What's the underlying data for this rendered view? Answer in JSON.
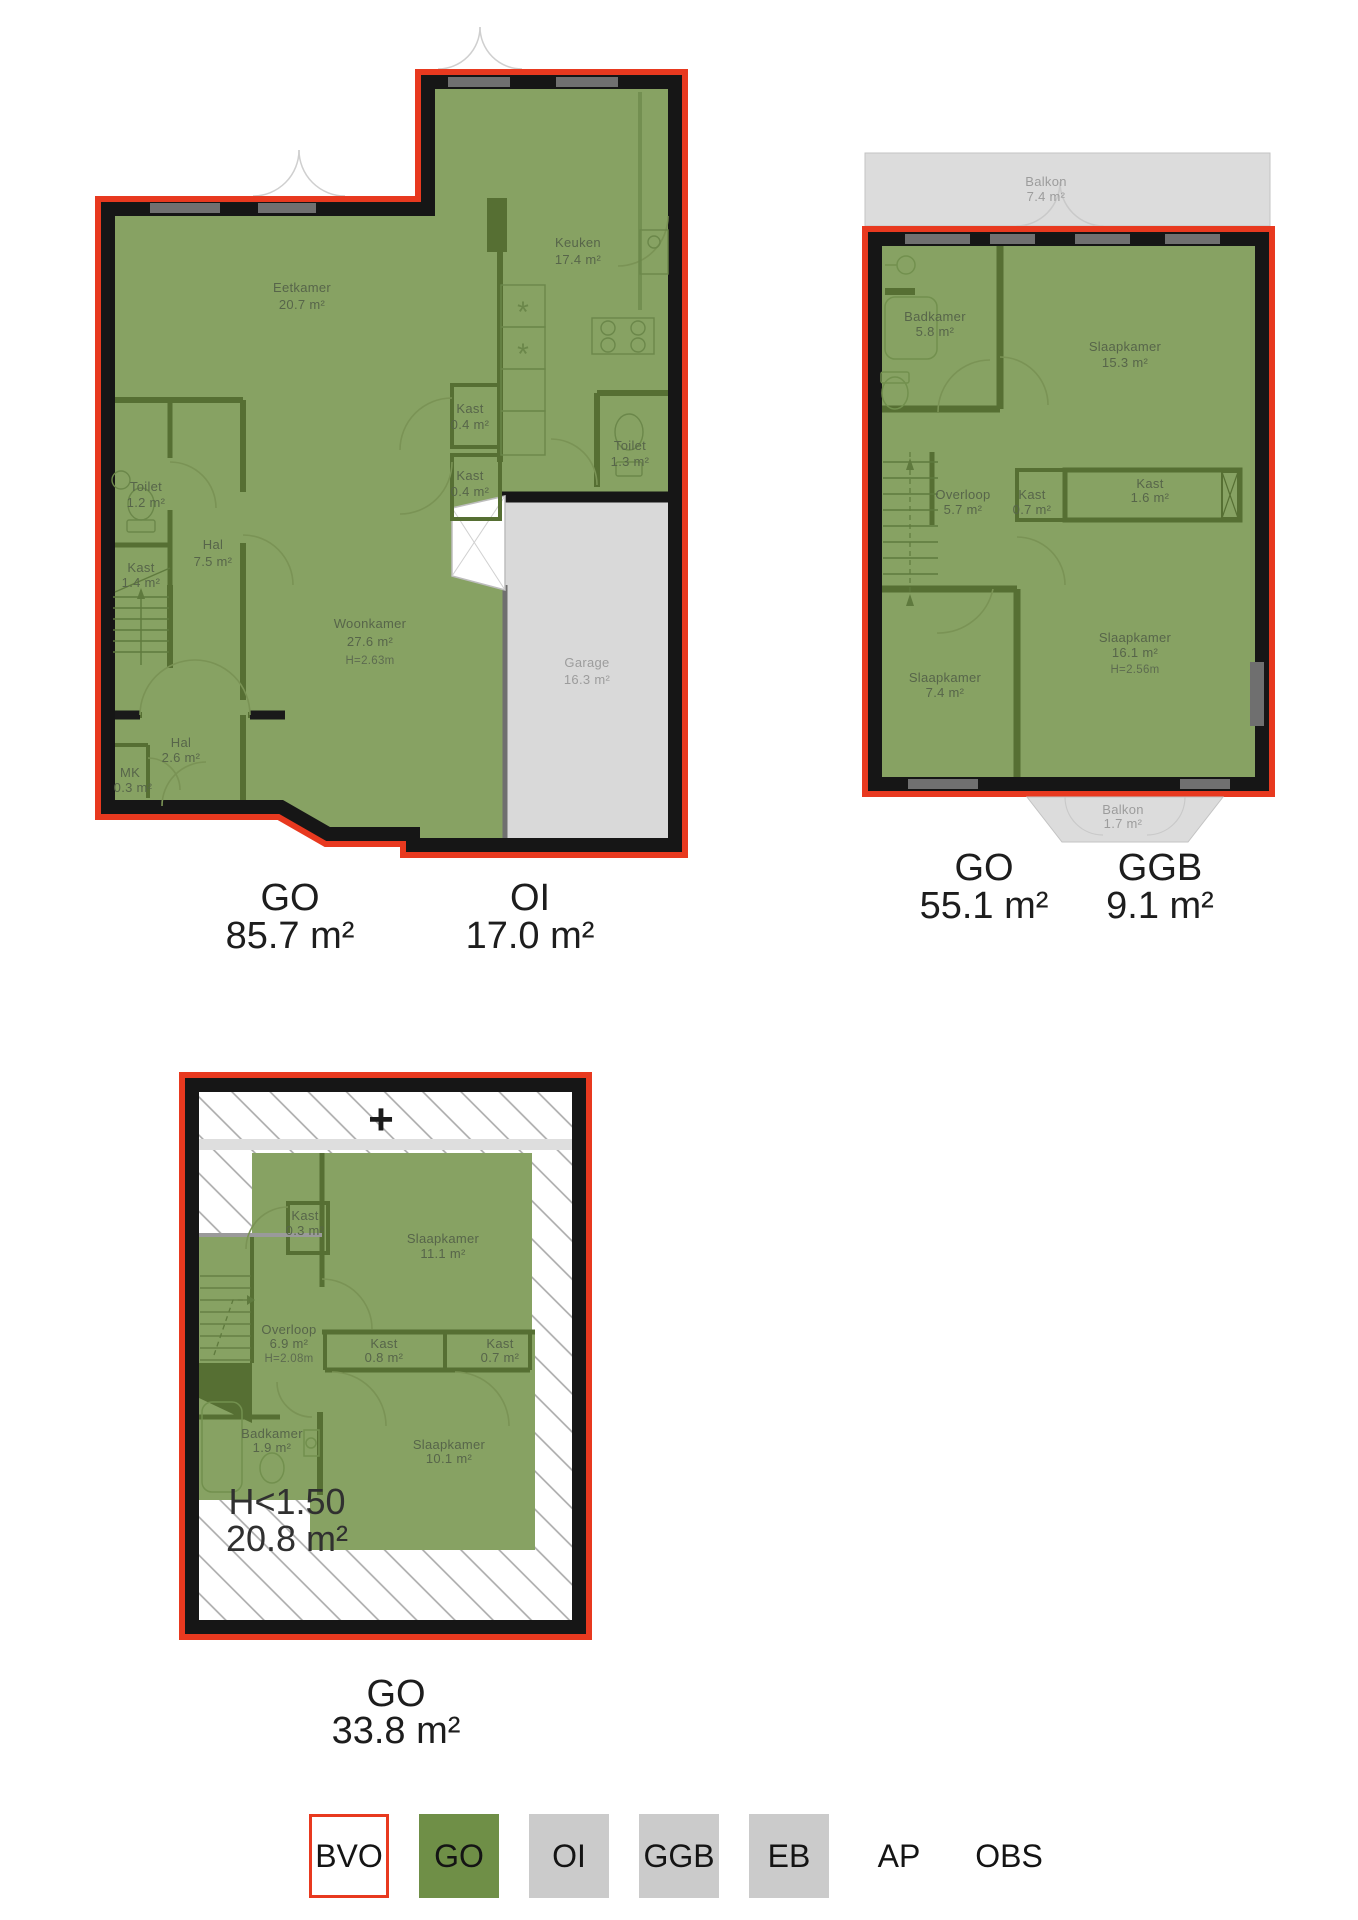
{
  "colors": {
    "outline_red": "#e8391f",
    "wall_black": "#161616",
    "floor_green": "#87a263",
    "wall_green": "#566f33",
    "gray_fill": "#d9d9d9",
    "legend_green": "#6f8f47",
    "legend_gray": "#cbcbcb"
  },
  "plans": {
    "ground_floor": {
      "rooms": [
        {
          "name": "Eetkamer",
          "area": "20.7 m²"
        },
        {
          "name": "Keuken",
          "area": "17.4 m²"
        },
        {
          "name": "Kast",
          "area": "0.4 m²"
        },
        {
          "name": "Kast",
          "area": "0.4 m²"
        },
        {
          "name": "Toilet",
          "area": "1.3 m²"
        },
        {
          "name": "Toilet",
          "area": "1.2 m²"
        },
        {
          "name": "Kast",
          "area": "1.4 m²"
        },
        {
          "name": "Hal",
          "area": "7.5 m²"
        },
        {
          "name": "Woonkamer",
          "area": "27.6 m²",
          "height": "H=2.63m"
        },
        {
          "name": "Hal",
          "area": "2.6 m²"
        },
        {
          "name": "MK",
          "area": "0.3 m²"
        },
        {
          "name": "Garage",
          "area": "16.3 m²"
        }
      ],
      "area_labels": [
        {
          "code": "GO",
          "value": "85.7 m²"
        },
        {
          "code": "OI",
          "value": "17.0 m²"
        }
      ]
    },
    "first_floor": {
      "rooms": [
        {
          "name": "Balkon",
          "area": "7.4 m²"
        },
        {
          "name": "Badkamer",
          "area": "5.8 m²"
        },
        {
          "name": "Slaapkamer",
          "area": "15.3 m²"
        },
        {
          "name": "Overloop",
          "area": "5.7 m²"
        },
        {
          "name": "Kast",
          "area": "0.7 m²"
        },
        {
          "name": "Kast",
          "area": "1.6 m²"
        },
        {
          "name": "Slaapkamer",
          "area": "7.4 m²"
        },
        {
          "name": "Slaapkamer",
          "area": "16.1 m²",
          "height": "H=2.56m"
        },
        {
          "name": "Balkon",
          "area": "1.7 m²"
        }
      ],
      "area_labels": [
        {
          "code": "GO",
          "value": "55.1 m²"
        },
        {
          "code": "GGB",
          "value": "9.1 m²"
        }
      ]
    },
    "attic": {
      "plus_symbol": "+",
      "rooms": [
        {
          "name": "Kast",
          "area": "0.3 m²"
        },
        {
          "name": "Slaapkamer",
          "area": "11.1 m²"
        },
        {
          "name": "Overloop",
          "area": "6.9 m²",
          "height": "H=2.08m"
        },
        {
          "name": "Kast",
          "area": "0.8 m²"
        },
        {
          "name": "Kast",
          "area": "0.7 m²"
        },
        {
          "name": "Badkamer",
          "area": "1.9 m²"
        },
        {
          "name": "Slaapkamer",
          "area": "10.1 m²"
        }
      ],
      "low_height_label": {
        "code": "H<1.50",
        "value": "20.8 m²"
      },
      "area_labels": [
        {
          "code": "GO",
          "value": "33.8 m²"
        }
      ]
    }
  },
  "legend": {
    "items": [
      {
        "label": "BVO",
        "swatch": "outline-red"
      },
      {
        "label": "GO",
        "swatch": "green"
      },
      {
        "label": "OI",
        "swatch": "gray"
      },
      {
        "label": "GGB",
        "swatch": "gray"
      },
      {
        "label": "EB",
        "swatch": "gray"
      },
      {
        "label": "AP",
        "swatch": "none"
      },
      {
        "label": "OBS",
        "swatch": "none"
      }
    ]
  }
}
